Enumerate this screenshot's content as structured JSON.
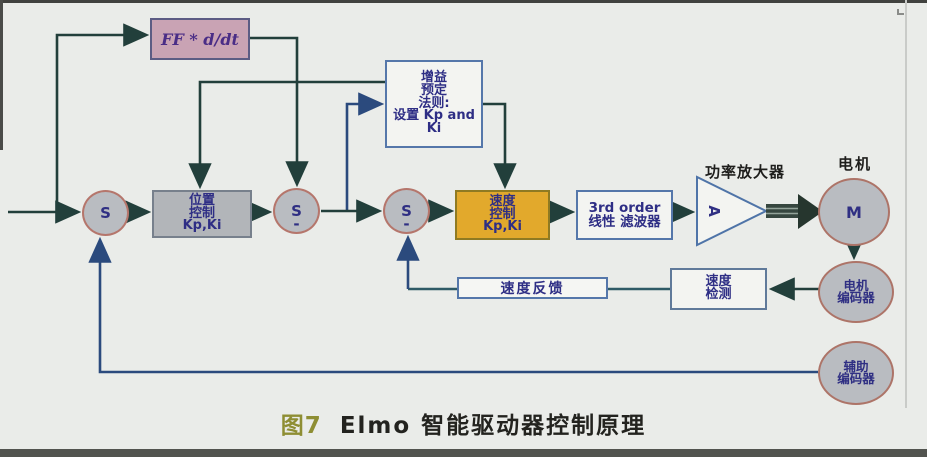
{
  "figure": {
    "caption_prefix": "图7",
    "caption_title": "Elmo 智能驱动器控制原理"
  },
  "blocks": {
    "feedforward": {
      "label": "FF * d/dt"
    },
    "gain_schedule": {
      "label": "增益\n预定\n法则:\n设置 Kp and\nKi"
    },
    "position_ctrl": {
      "label": "位置\n控制\nKp,Ki"
    },
    "speed_ctrl": {
      "label": "速度\n控制\nKp,Ki"
    },
    "filter": {
      "label": "3rd order\n线性 滤波器"
    },
    "speed_feedback": {
      "label": "速度反馈"
    },
    "speed_detect": {
      "label": "速度\n检测"
    },
    "sum1": {
      "label": "S"
    },
    "sum2": {
      "label": "S",
      "sign": "-"
    },
    "sum3": {
      "label": "S",
      "sign": "-"
    },
    "amplifier": {
      "label": "A",
      "title": "功率放大器"
    },
    "motor": {
      "label": "M",
      "title": "电机"
    },
    "motor_encoder": {
      "label": "电机\n编码器"
    },
    "aux_encoder": {
      "label": "辅助\n编码器"
    }
  },
  "colors": {
    "background": "#eaece9",
    "feedforward_box": "#c9a3b4",
    "position_box": "#b2b5b9",
    "speed_box": "#e2a92c",
    "white_box": "#f3f4f1",
    "circle_fill": "#b9bcc1",
    "circle_border": "#b5766c",
    "wire_dark": "#223f3b",
    "wire_blue": "#2b4a7d",
    "caption_number": "#8e8e33",
    "box_text": "#2e2e85"
  }
}
